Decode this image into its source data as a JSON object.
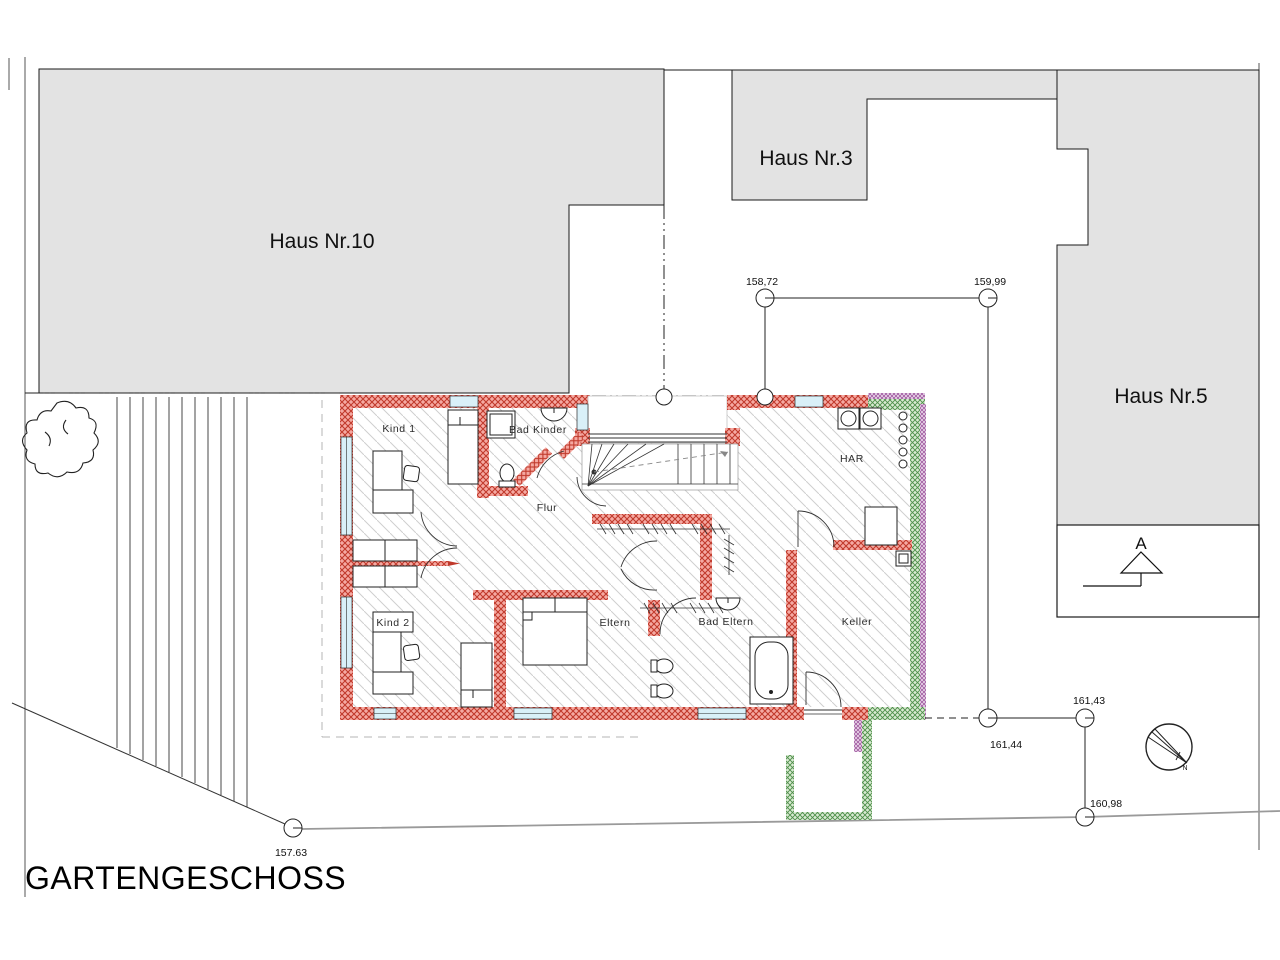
{
  "title": "GARTENGESCHOSS",
  "houses": {
    "h10": "Haus Nr.10",
    "h3": "Haus Nr.3",
    "h5": "Haus Nr.5"
  },
  "rooms": {
    "kind1": "Kind 1",
    "bad_kinder": "Bad Kinder",
    "flur": "Flur",
    "kind2": "Kind 2",
    "eltern": "Eltern",
    "bad_eltern": "Bad Eltern",
    "har": "HAR",
    "keller": "Keller"
  },
  "elevations": {
    "p1": "158,72",
    "p2": "159,99",
    "p3": "161,44",
    "p4": "161,43",
    "p5": "160,98",
    "p6": "157.63"
  },
  "section": {
    "label": "A"
  },
  "compass": {
    "label": "N"
  },
  "colors": {
    "wall_red_line": "#c0392b",
    "wall_red_bg": "#f5a9a2",
    "insulation_green_line": "#4e8f4a",
    "insulation_green_bg": "#d9ead2",
    "seal_purple_line": "#9f5aa0",
    "seal_purple_bg": "#ecd9ec",
    "window_blue": "#d9f0f8",
    "site_gray": "#e3e3e3",
    "hatch_gray": "#cfcfcf"
  }
}
